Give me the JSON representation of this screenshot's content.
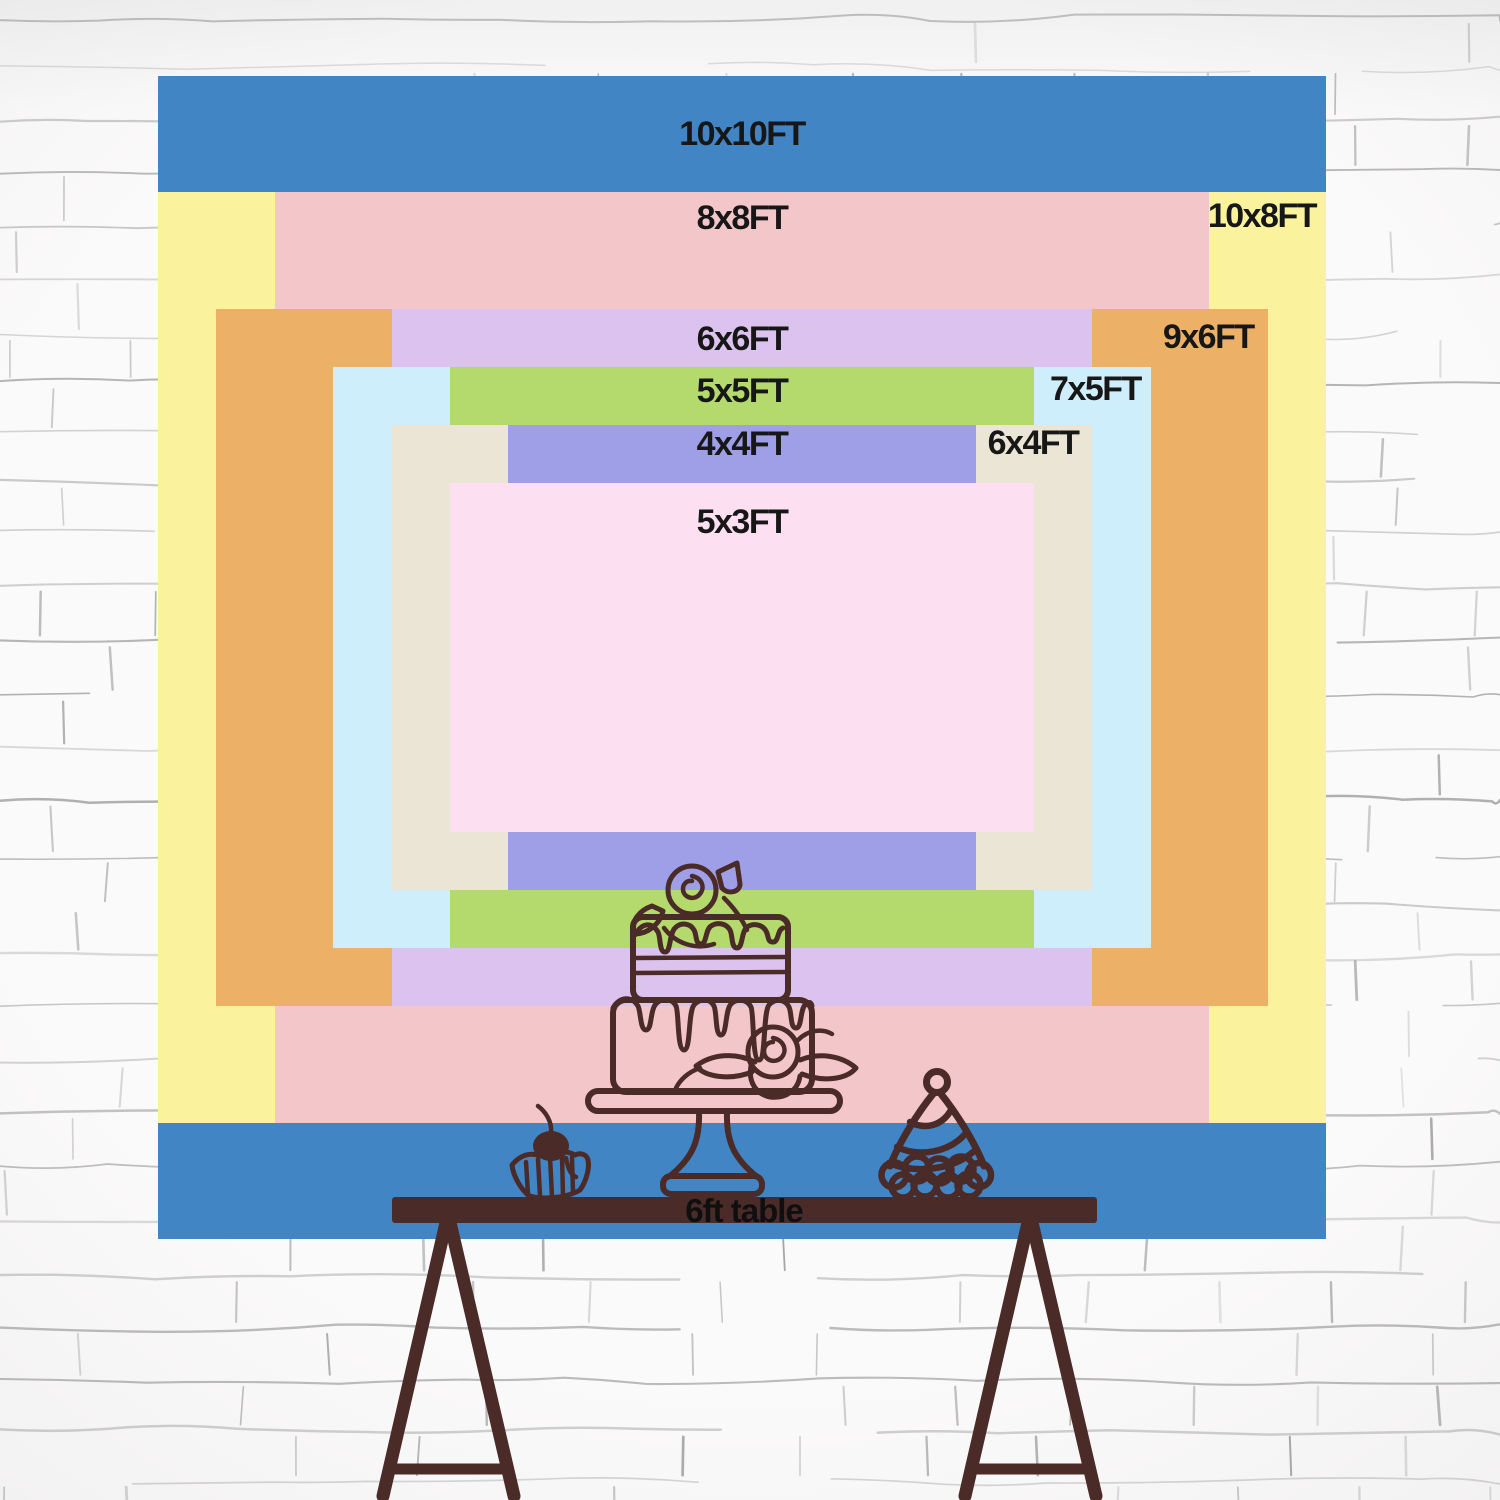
{
  "page": {
    "type": "backdrop size comparison chart",
    "background": "white painted brick wall"
  },
  "size_chart": {
    "layers": [
      {
        "label": "10x10FT",
        "width_ft": 10,
        "height_ft": 10,
        "color": "#4285c5",
        "label_align": "center",
        "label_dy": 38
      },
      {
        "label": "10x8FT",
        "width_ft": 10,
        "height_ft": 8,
        "color": "#faf29d",
        "label_align": "right",
        "label_dy": 4,
        "label_dx": 10
      },
      {
        "label": "8x8FT",
        "width_ft": 8,
        "height_ft": 8,
        "color": "#f3c6c9",
        "label_align": "center",
        "label_dy": 6
      },
      {
        "label": "9x6FT",
        "width_ft": 9,
        "height_ft": 6,
        "color": "#ecb167",
        "label_align": "right",
        "label_dy": 8,
        "label_dx": 14
      },
      {
        "label": "6x6FT",
        "width_ft": 6,
        "height_ft": 6,
        "color": "#dcc3ef",
        "label_align": "center",
        "label_dy": 10
      },
      {
        "label": "7x5FT",
        "width_ft": 7,
        "height_ft": 5,
        "color": "#cdeefa",
        "label_align": "right",
        "label_dy": 2,
        "label_dx": 10
      },
      {
        "label": "5x5FT",
        "width_ft": 5,
        "height_ft": 5,
        "color": "#b4d96c",
        "label_align": "center",
        "label_dy": 4
      },
      {
        "label": "6x4FT",
        "width_ft": 6,
        "height_ft": 4,
        "color": "#eae5d5",
        "label_align": "right",
        "label_dy": -2,
        "label_dx": 14
      },
      {
        "label": "4x4FT",
        "width_ft": 4,
        "height_ft": 4,
        "color": "#9e9fe7",
        "label_align": "center",
        "label_dy": -1
      },
      {
        "label": "5x3FT",
        "width_ft": 5,
        "height_ft": 3,
        "color": "#fcdff1",
        "label_align": "center",
        "label_dy": 19
      }
    ]
  },
  "table": {
    "label": "6ft table"
  },
  "decorations": {
    "cake": "two-tier drip cake with roses on pedestal stand, line art",
    "cupcake": "cupcake with cherry on top, line art",
    "party_hat": "striped party hat with pompom and ruffle, line art",
    "table": "trestle table with A-frame legs, line art"
  },
  "colors": {
    "line_art": "#4a2b27",
    "label_text": "#171717",
    "blue_band": "#4285c5"
  }
}
